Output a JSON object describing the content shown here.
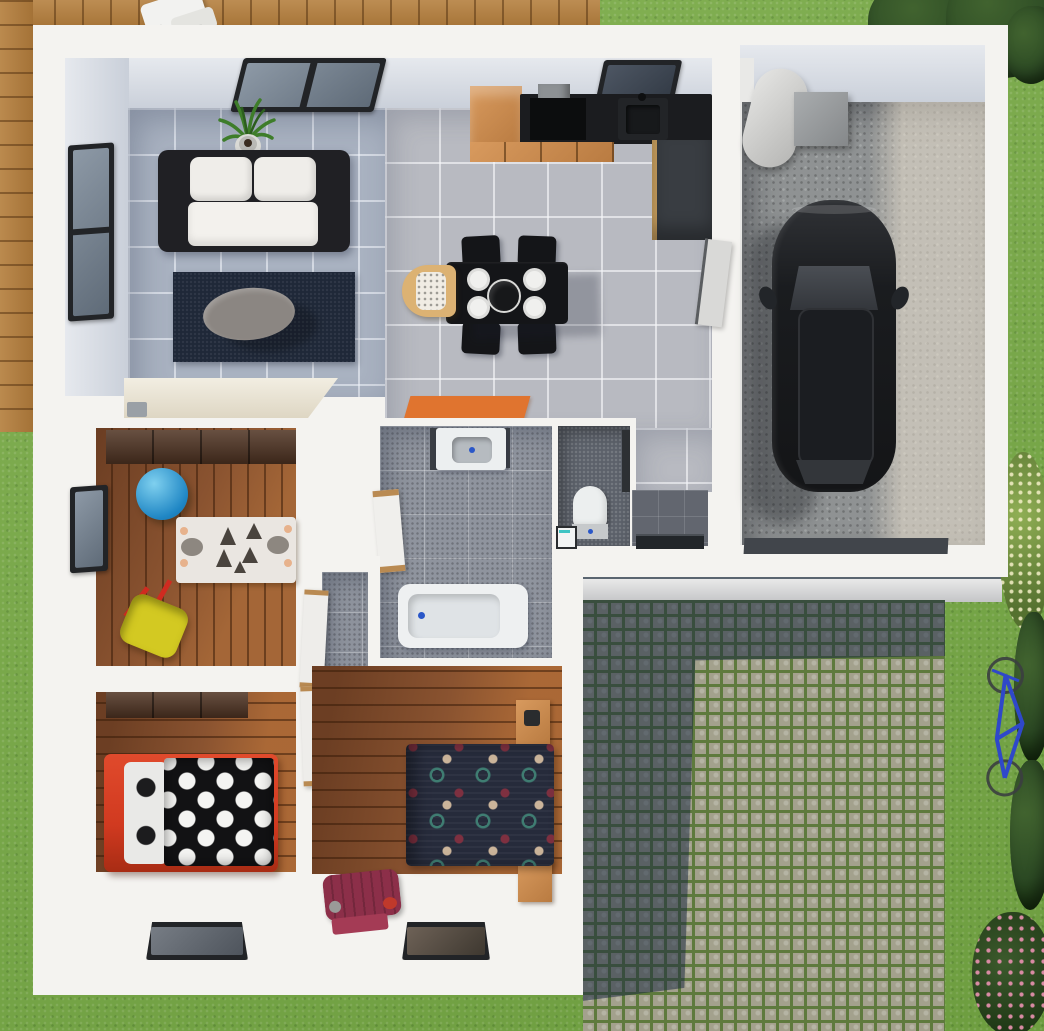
{
  "meta": {
    "description": "3D rendered top-down floor plan of a small single-storey house with attached garage, lawn, wooden deck and cobblestone driveway",
    "view": "bird's-eye architectural render",
    "visible_text": "none"
  },
  "palette": {
    "grass": "#7aab47",
    "hedge": "#2c4a24",
    "bushLight": "#8fae54",
    "flowerPink": "#d98ba4",
    "deck": "#b5803f",
    "houseWall": "#f4f3f0",
    "faceLight": "#e6e9ee",
    "faceDark": "#c9cfd9",
    "livingTile": "#a9b2c1",
    "kitchenTile": "#b8bac1",
    "bathFloor": "#8f949e",
    "wcFloor": "#5c616a",
    "woodFloor": "#8a5330",
    "walnut": "#4f3322",
    "rugNavy": "#1f2838",
    "coffeeTable": "#8b8682",
    "sofaDark": "#202024",
    "sofaWhite": "#efede9",
    "counterBlack": "#1b1c1f",
    "oak": "#c88f55",
    "charcoal": "#393d42",
    "tableBlack": "#141518",
    "plate": "#f0f0ee",
    "highchair": "#dcb273",
    "matOrange": "#e0742f",
    "vanity": "#eceff0",
    "tubWhite": "#eef0f1",
    "toiletWhite": "#ecefef",
    "blueAccent": "#2a57c8",
    "bedRed": "#d13a20",
    "duvetBlack": "#121214",
    "duvetNavy": "#262b3b",
    "duvetTeal": "#3f7d72",
    "duvetMaroon": "#7e3040",
    "duvetBeige": "#cbb49a",
    "suitcase": "#8c2f49",
    "concrete": "#8f9293",
    "car": "#17181b",
    "carGlass": "#34373c",
    "cobble": "#a3a18d",
    "cobbleJoint": "#5e7a3d",
    "stepGray": "#c9cacc",
    "bikeBlue": "#2f48c9",
    "ball": "#2ea8e0",
    "toyYellow": "#d3c922",
    "toyRed": "#cf2b20",
    "plantGreen": "#3e7d2a",
    "pot": "#dadad6",
    "doorWood": "#b98a52"
  },
  "scene": {
    "exterior": {
      "lawn": "green grass surrounding the house",
      "deck": "wooden deck along top-left with white lounge chair",
      "driveway": "cobblestone pavers with mossy joints, partly in building shadow",
      "entrance_step": "light gray step strip in front of driveway",
      "bicycle": "blue bicycle lying on lawn right of driveway",
      "hedges": [
        "dark hedge top-right corner",
        "flowering shrub right of garage",
        "dark shrubs along right edge",
        "pink flowering bush bottom-right corner"
      ]
    },
    "rooms": [
      {
        "name": "living-room",
        "floor": "blue-gray tiles",
        "items": [
          "white sofa with dark frame",
          "navy rug",
          "gray oval coffee table",
          "potted plant",
          "cream sideboard",
          "small radio",
          "side window",
          "large patio window"
        ]
      },
      {
        "name": "kitchen-dining",
        "floor": "light gray tiles",
        "items": [
          "oak cabinet column",
          "black countertop",
          "cooktop with hood",
          "sink with faucet",
          "oak drawer fronts",
          "tall charcoal cabinet",
          "door to garage",
          "black dining table",
          "four black chairs",
          "four white plates",
          "black serving bowl",
          "wooden high chair",
          "kitchen window"
        ]
      },
      {
        "name": "hallway",
        "floor": "pale gray tiles",
        "items": [
          "orange doormat"
        ]
      },
      {
        "name": "bathroom",
        "floor": "gray speckled tiles",
        "items": [
          "white vanity with basin",
          "bathtub",
          "wood-trimmed door"
        ]
      },
      {
        "name": "wc",
        "floor": "dark speckled tiles",
        "items": [
          "toilet",
          "mini basin"
        ]
      },
      {
        "name": "entry-vestibule",
        "floor": "dark gray tiles",
        "items": [
          "front door"
        ]
      },
      {
        "name": "kids-room",
        "floor": "wood planks",
        "items": [
          "walnut wardrobe",
          "blue gym ball",
          "zebra play rug",
          "yellow toy wheelbarrow",
          "side window"
        ]
      },
      {
        "name": "inner-corridor",
        "floor": "gray tiles",
        "items": [
          "three wood-trimmed doors"
        ]
      },
      {
        "name": "bedroom-1",
        "floor": "wood planks",
        "items": [
          "red bed with black polka-dot duvet",
          "striped pillow",
          "walnut wardrobe",
          "south window"
        ]
      },
      {
        "name": "bedroom-2",
        "floor": "wood planks",
        "items": [
          "double bed with patterned navy duvet",
          "two oak nightstands",
          "maroon suitcase",
          "south window"
        ]
      },
      {
        "name": "garage",
        "floor": "concrete",
        "items": [
          "black car",
          "water heater cylinder",
          "utility box",
          "dark threshold mat"
        ]
      }
    ]
  }
}
